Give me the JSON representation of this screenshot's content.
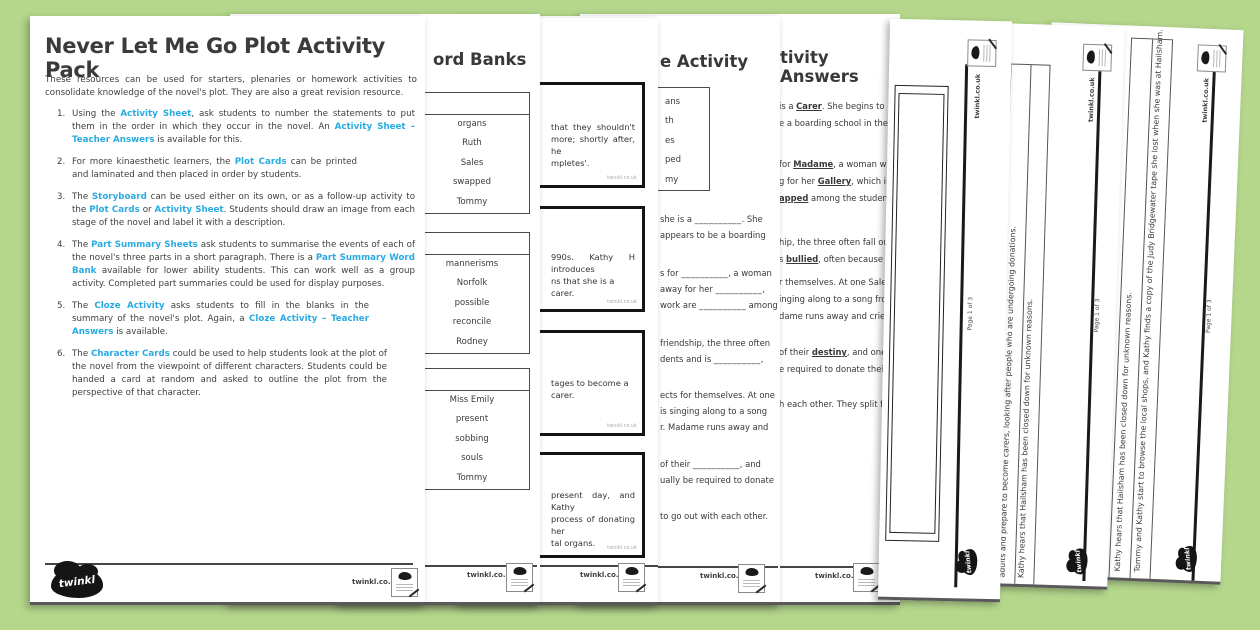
{
  "brand": {
    "logo_text": "twinkl",
    "site": "twinkl.co.uk",
    "page_label": "Page 1 of 3",
    "accent_blue": "#29abe2",
    "background_green": "#b5d78c"
  },
  "cover": {
    "title": "Never Let Me Go Plot Activity Pack",
    "intro": "These resources can be used for starters, plenaries or homework activities to consolidate knowledge of the novel's plot. They are also a great revision resource.",
    "items": [
      {
        "num": "1.",
        "segments": [
          {
            "t": "Using the "
          },
          {
            "t": "Activity Sheet",
            "hl": true
          },
          {
            "t": ", ask students to number the statements to put them in the order in which they occur in the novel. An "
          },
          {
            "t": "Activity Sheet – Teacher Answers",
            "hl": true
          },
          {
            "t": " is available for this."
          }
        ]
      },
      {
        "num": "2.",
        "segments": [
          {
            "t": "For more kinaesthetic learners, the "
          },
          {
            "t": "Plot Cards",
            "hl": true
          },
          {
            "t": " can be printed and laminated and then placed in order by students."
          }
        ]
      },
      {
        "num": "3.",
        "segments": [
          {
            "t": "The "
          },
          {
            "t": "Storyboard",
            "hl": true
          },
          {
            "t": " can be used either on its own, or as a follow-up activity to the "
          },
          {
            "t": "Plot Cards",
            "hl": true
          },
          {
            "t": " or "
          },
          {
            "t": "Activity Sheet",
            "hl": true
          },
          {
            "t": ". Students should draw an image from each stage of the novel and label it with a description."
          }
        ]
      },
      {
        "num": "4.",
        "segments": [
          {
            "t": "The "
          },
          {
            "t": "Part Summary Sheets",
            "hl": true
          },
          {
            "t": " ask students to summarise the events of each of the novel's three parts in a short paragraph. There is a "
          },
          {
            "t": "Part Summary Word Bank",
            "hl": true
          },
          {
            "t": " available for lower ability students. This can work well as a group activity. Completed part summaries could be used for display purposes."
          }
        ]
      },
      {
        "num": "5.",
        "segments": [
          {
            "t": "The "
          },
          {
            "t": "Cloze Activity",
            "hl": true
          },
          {
            "t": " asks students to fill in the blanks in the summary of the novel's plot. Again, a "
          },
          {
            "t": "Cloze Activity – Teacher Answers",
            "hl": true
          },
          {
            "t": " is available."
          }
        ]
      },
      {
        "num": "6.",
        "segments": [
          {
            "t": "The "
          },
          {
            "t": "Character Cards",
            "hl": true
          },
          {
            "t": " could be used to help students look at the plot of the novel from the viewpoint of different characters. Students could be handed a card at random and asked to outline the plot from the perspective of that character."
          }
        ]
      }
    ]
  },
  "word_banks_page": {
    "title_fragment": "ord Banks",
    "boxes": [
      {
        "words": [
          "organs",
          "Ruth",
          "Sales",
          "swapped",
          "Tommy"
        ]
      },
      {
        "words": [
          "mannerisms",
          "Norfolk",
          "possible",
          "reconcile",
          "Rodney"
        ]
      },
      {
        "words": [
          "Miss Emily",
          "present",
          "sobbing",
          "souls",
          "Tommy"
        ]
      }
    ]
  },
  "plot_cards_page": {
    "cards": [
      {
        "lines": [
          "that they shouldn't",
          "more; shortly after, he",
          "mpletes'."
        ]
      },
      {
        "lines": [
          "990s. Kathy H introduces",
          "ns that she is a carer."
        ]
      },
      {
        "lines": [
          "tages to become a carer."
        ]
      },
      {
        "lines": [
          "present day, and Kathy",
          "process of donating her",
          "tal organs."
        ]
      }
    ]
  },
  "cloze_page": {
    "title_fragment": "e Activity",
    "blank_placeholder": "__________",
    "word_bank_fragments": [
      "ans",
      "th",
      "es",
      "ped",
      "my"
    ],
    "blocks": [
      {
        "lines": [
          [
            {
              "t": "she is a "
            },
            {
              "blank": true
            },
            {
              "t": ". She"
            }
          ],
          [
            {
              "t": "appears to be a boarding"
            }
          ]
        ]
      },
      {
        "lines": [
          [
            {
              "t": "s for "
            },
            {
              "blank": true
            },
            {
              "t": ", a woman"
            }
          ],
          [
            {
              "t": "away for her "
            },
            {
              "blank": true
            },
            {
              "t": ","
            }
          ],
          [
            {
              "t": "work are "
            },
            {
              "blank": true
            },
            {
              "t": " among"
            }
          ]
        ]
      },
      {
        "lines": [
          [
            {
              "t": "friendship, the three often"
            }
          ],
          [
            {
              "t": "dents and is "
            },
            {
              "blank": true
            },
            {
              "t": ","
            }
          ]
        ]
      },
      {
        "lines": [
          [
            {
              "t": "ects for themselves. At one"
            }
          ],
          [
            {
              "t": "is singing along to a song"
            }
          ],
          [
            {
              "t": "r. Madame runs away and"
            }
          ]
        ]
      },
      {
        "lines": [
          [
            {
              "t": "of their "
            },
            {
              "blank": true
            },
            {
              "t": ", and"
            }
          ],
          [
            {
              "t": "ually be required to donate"
            }
          ]
        ]
      },
      {
        "lines": [
          [
            {
              "t": "to go out with each other."
            }
          ]
        ]
      }
    ]
  },
  "answers_page": {
    "title_fragment": "tivity Answers",
    "blocks": [
      {
        "lines": [
          [
            {
              "t": "is a "
            },
            {
              "t": "Carer",
              "ans": true
            },
            {
              "t": ". She begins to"
            }
          ],
          [
            {
              "t": "e a boarding school in the"
            }
          ]
        ]
      },
      {
        "lines": [
          [
            {
              "t": "for "
            },
            {
              "t": "Madame",
              "ans": true
            },
            {
              "t": ", a woman who"
            }
          ],
          [
            {
              "t": "g for her "
            },
            {
              "t": "Gallery",
              "ans": true
            },
            {
              "t": ", which is"
            }
          ],
          [
            {
              "t": "apped",
              "ans": true
            },
            {
              "t": " among the students"
            }
          ]
        ]
      },
      {
        "lines": [
          [
            {
              "t": "hip, the three often fall out"
            }
          ],
          [
            {
              "t": "s "
            },
            {
              "t": "bullied",
              "ans": true
            },
            {
              "t": ", often because he"
            }
          ]
        ]
      },
      {
        "lines": [
          [
            {
              "t": "r themselves. At one Sale,"
            }
          ],
          [
            {
              "t": "inging along to a song from"
            }
          ],
          [
            {
              "t": "dame runs away and cries,"
            }
          ]
        ]
      },
      {
        "lines": [
          [
            {
              "t": "of their "
            },
            {
              "t": "destiny",
              "ans": true
            },
            {
              "t": ", and one"
            }
          ],
          [
            {
              "t": "e required to donate their"
            }
          ]
        ]
      },
      {
        "lines": [
          [
            {
              "t": "h each other. They split for"
            }
          ]
        ]
      }
    ]
  },
  "storyboard_page": {
    "page_label": "Page 1 of 3"
  },
  "statement_pages": [
    {
      "statements": [
        "adults and prepare to become carers, looking after people who are undergoing donations.",
        "Kathy hears that Hailsham has been closed down for unknown reasons."
      ]
    },
    {
      "statements": [
        "Kathy hears that Hailsham has been closed down for unknown reasons.",
        "Tommy and Kathy start to browse the local shops, and Kathy finds a copy of the Judy Bridgewater tape she lost when she was at Hailsham."
      ]
    }
  ]
}
